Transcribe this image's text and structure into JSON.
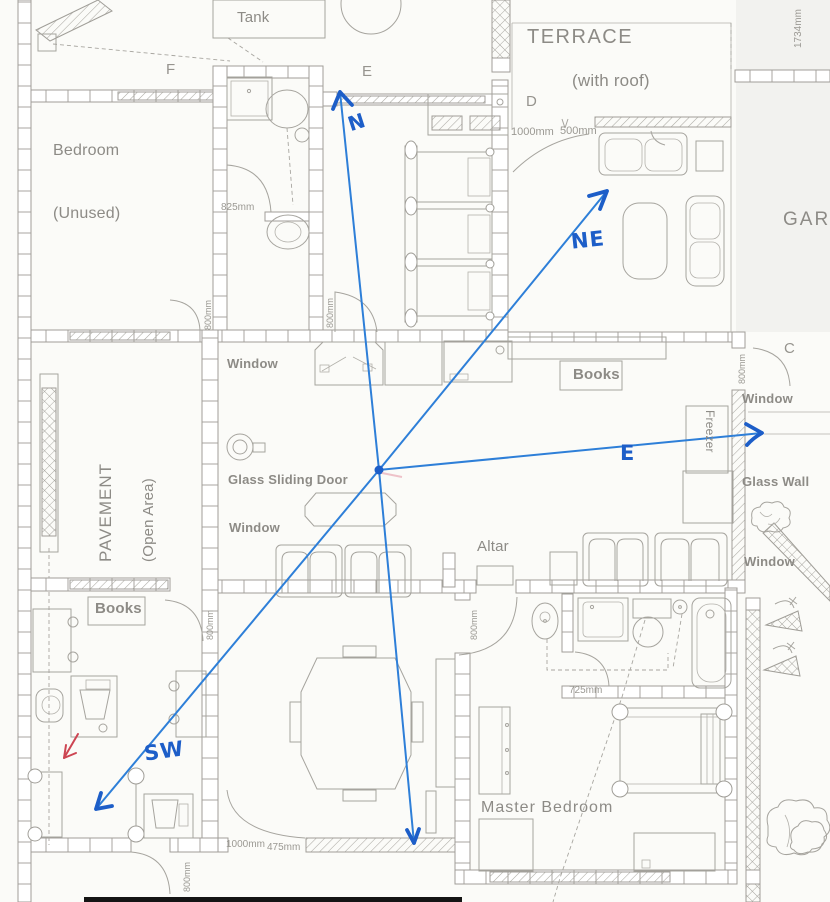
{
  "colors": {
    "paper": "#fbfbf8",
    "plan_line": "#a6a49e",
    "plan_text": "#8d8b86",
    "ink_blue": "#2e7fd8",
    "ink_blue_dark": "#1d5ec8",
    "ink_red": "#cd4552"
  },
  "rooms": {
    "bedroom": {
      "name": "Bedroom",
      "qualifier": "(Unused)"
    },
    "terrace": {
      "name": "TERRACE",
      "qualifier": "(with roof)"
    },
    "pavement": {
      "name": "PAVEMENT",
      "qualifier": "(Open Area)"
    },
    "master_bedroom": {
      "name": "Master Bedroom"
    },
    "garage": {
      "name": "GAR"
    }
  },
  "features": {
    "tank": "Tank",
    "window": "Window",
    "glass_sliding_door": "Glass Sliding Door",
    "books": "Books",
    "freezer": "Freezer",
    "glass_wall": "Glass Wall",
    "altar": "Altar"
  },
  "markers": {
    "f": "F",
    "e": "E",
    "d": "D",
    "c": "C"
  },
  "dimensions": {
    "d825": "825mm",
    "d800": "800mm",
    "d1000": "1000mm",
    "d500": "500mm",
    "d475": "475mm",
    "d725": "725mm",
    "d1734": "1734mm"
  },
  "compass": {
    "north": "N",
    "northeast": "NE",
    "east": "E",
    "southwest": "SW"
  }
}
